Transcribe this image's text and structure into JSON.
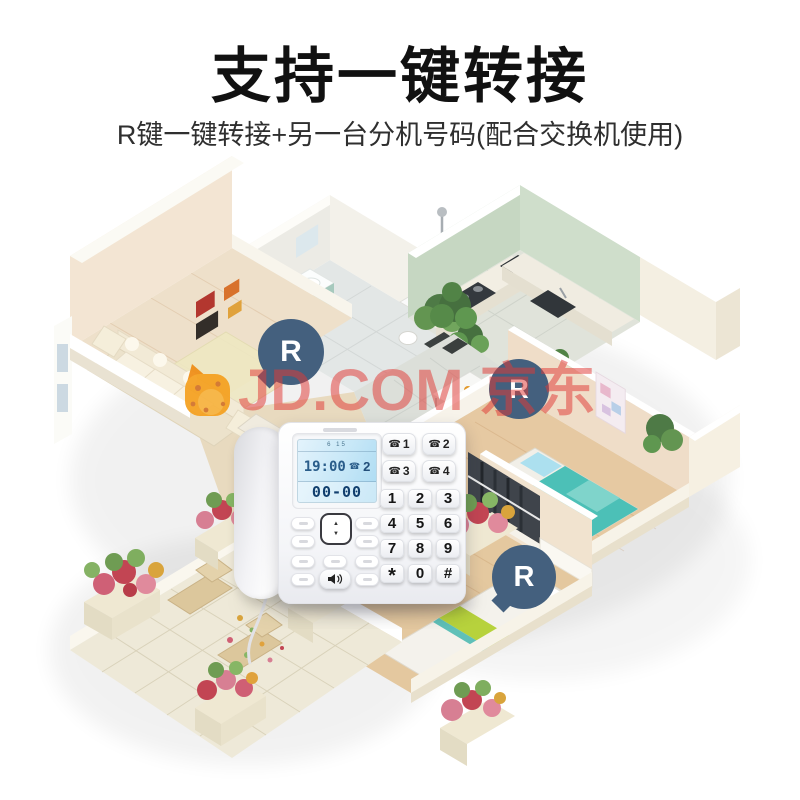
{
  "page": {
    "background": "#ffffff",
    "width": 800,
    "height": 800
  },
  "header": {
    "title": "支持一键转接",
    "subtitle": "R键一键转接+另一台分机号码(配合交换机使用)",
    "title_color": "#111111",
    "subtitle_color": "#2f2f2f"
  },
  "watermark": {
    "text": "JD.COM 京东",
    "color": "#e13a36",
    "opacity": 0.52,
    "mascot": "jd-joy-dog-icon",
    "mascot_color": "#f5a01e"
  },
  "transfer_badges": {
    "label": "R",
    "count": 3,
    "color": "#44607e",
    "text_color": "#ffffff"
  },
  "phone": {
    "lcd": {
      "date_row": "6 15",
      "time": "19:00",
      "call_icon": "☎",
      "call_count": "2",
      "number": "00-00",
      "bg": "#c6e7f7",
      "digit_color": "#123f6e"
    },
    "memory_icon": "☎",
    "memory_keys": [
      "1",
      "2",
      "3",
      "4"
    ],
    "keypad": [
      "1",
      "2",
      "3",
      "4",
      "5",
      "6",
      "7",
      "8",
      "9",
      "*",
      "0",
      "#"
    ],
    "nav": {
      "up": "▲",
      "down": "▼"
    }
  },
  "floorplan": {
    "style": "isometric-cutaway-apartment",
    "rooms": [
      "living-room",
      "bathroom",
      "kitchen",
      "dining-area",
      "kids-bedroom",
      "bedroom",
      "patio-garden"
    ],
    "palette": {
      "walls": "#f3e6d4",
      "wall_tops": "#ffffff",
      "wood_floor": "#e6c9a2",
      "tile_floor": "#e0e3dd",
      "sage_wall": "#c6d7c2",
      "mint_cabinet": "#b7d6cb",
      "teal_bedding": "#4cc0b7",
      "lime_accent": "#b7d23c",
      "flower_pink": "#d77f93",
      "plant_green": "#4e7a46"
    }
  }
}
